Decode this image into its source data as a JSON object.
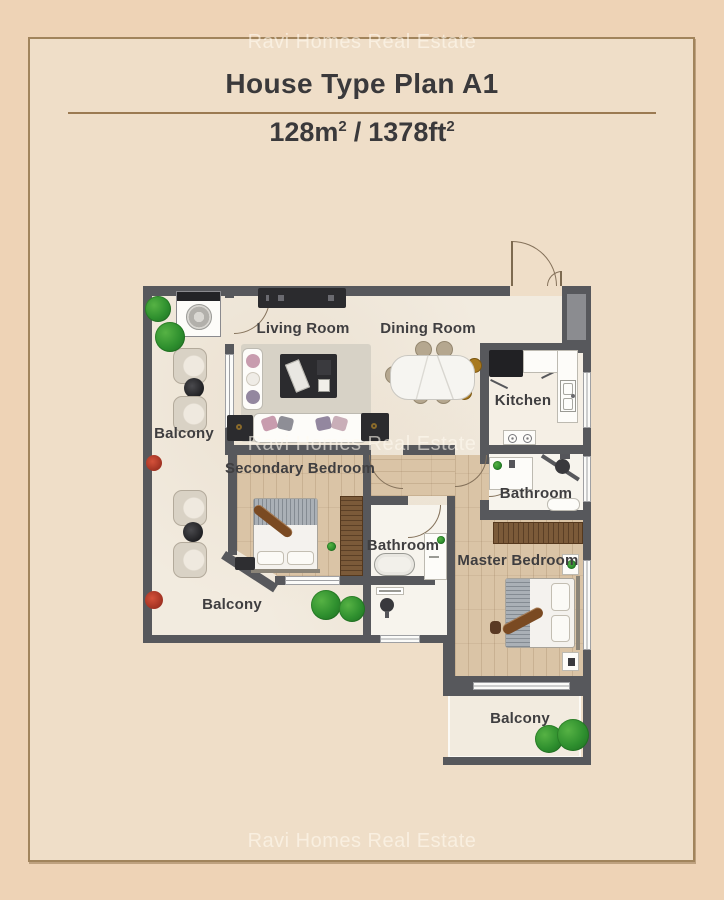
{
  "watermarks": {
    "top": "Ravi Homes Real Estate",
    "middle": "Ravi Homes Real Estate",
    "bottom": "Ravi Homes Real Estate"
  },
  "header": {
    "title": "House Type Plan A1",
    "area_metric": "128m",
    "area_metric_sup": "2",
    "area_separator": "/",
    "area_imperial": "1378ft",
    "area_imperial_sup": "2"
  },
  "plan": {
    "labels": {
      "balcony_top": "Balcony",
      "living": "Living Room",
      "dining": "Dining Room",
      "kitchen": "Kitchen",
      "secondary": "Secondary Bedroom",
      "bathroom_mid": "Bathroom",
      "bathroom_top": "Bathroom",
      "master": "Master Bedroom",
      "balcony_left": "Balcony",
      "balcony_bottom": "Balcony"
    }
  },
  "colors": {
    "page_bg": "#eed3b6",
    "panel_bg": "#efdec8",
    "frame_border": "#a1845c",
    "divider_line": "#9b7a52",
    "title_text": "#3a393b",
    "label_text": "#3f3e40",
    "wall": "#57585c",
    "wood_floor": "#dac4a6",
    "cream_floor": "#f2ebdf",
    "bath_floor": "#f7f4ed",
    "dark_furniture": "#2b2b2e",
    "wardrobe_brown": "#7b5a39",
    "plant_green": "#2e8f2e",
    "watermark": "rgba(255,250,240,0.6)"
  }
}
